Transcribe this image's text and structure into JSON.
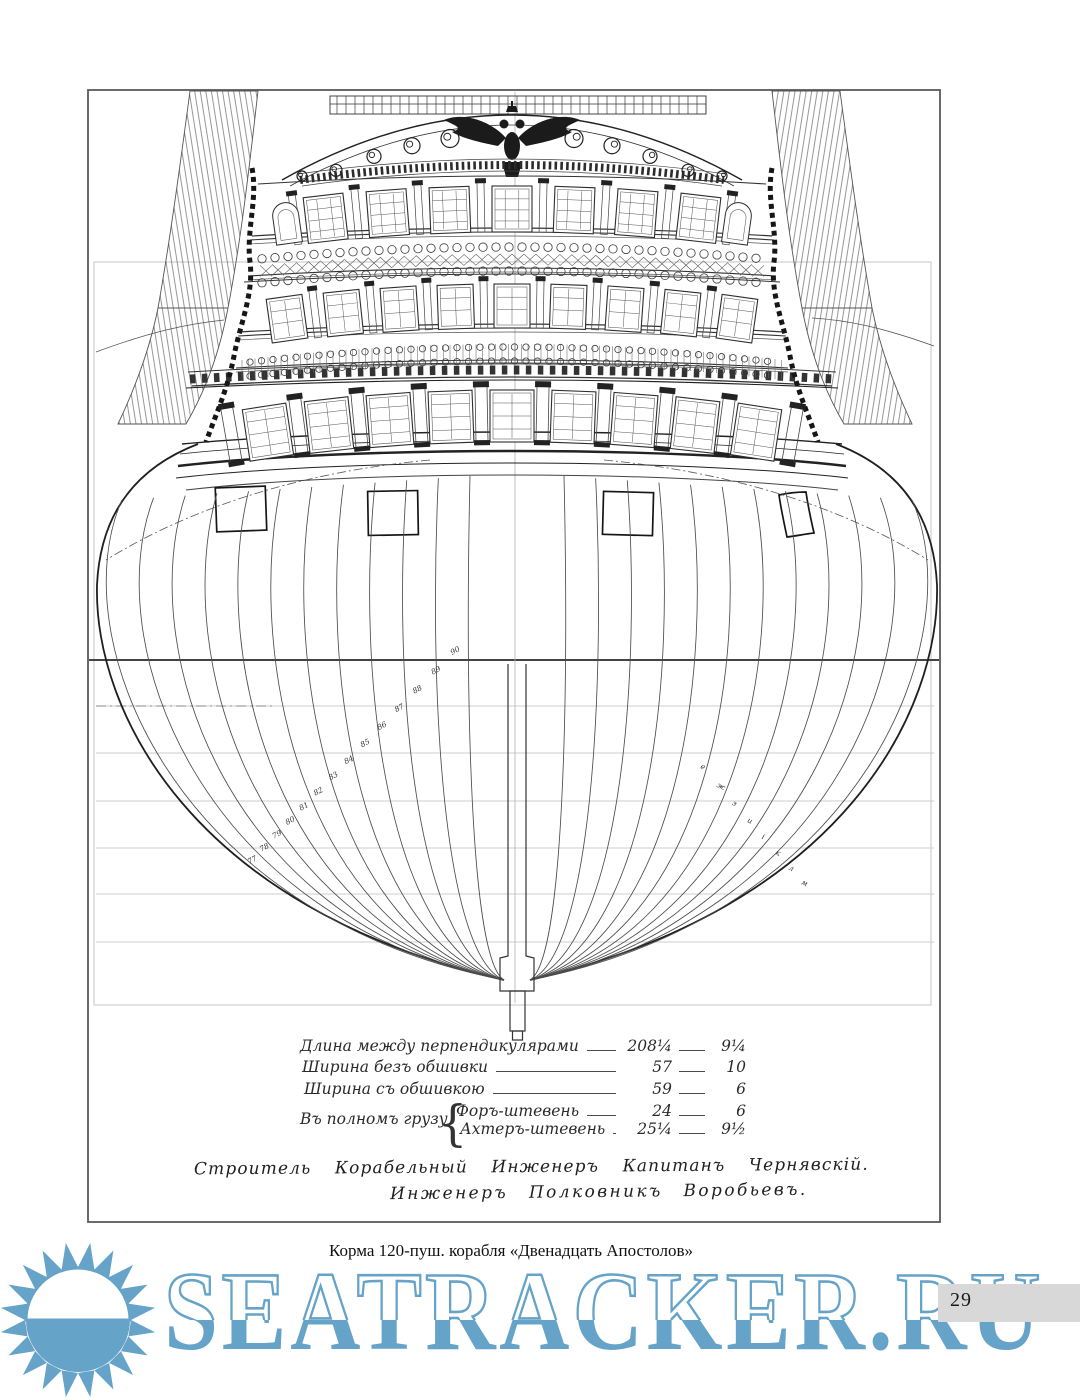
{
  "page_number": "29",
  "caption": "Корма 120-пуш. корабля «Двенадцать Апостолов»",
  "watermark": {
    "text": "SEATRACKER.RU",
    "color": "#66a3c8",
    "icon": "sun-icon"
  },
  "dimension_table": {
    "group_label": "Въ полномъ грузу",
    "rows": [
      {
        "label": "Длина между перпендикулярами",
        "feet": "208¼",
        "inches": "9¼"
      },
      {
        "label": "Ширина безъ обшивки",
        "feet": "57",
        "inches": "10"
      },
      {
        "label": "Ширина съ обшивкою",
        "feet": "59",
        "inches": "6"
      },
      {
        "label": "Форъ-штевень",
        "feet": "24",
        "inches": "6"
      },
      {
        "label": "Ахтеръ-штевень",
        "feet": "25¼",
        "inches": "9½"
      }
    ]
  },
  "signatures": {
    "line1": "Строитель Корабельный Инженеръ Капитанъ Чернявскій.",
    "line2": "Инженеръ Полковникъ Воробьевъ."
  },
  "drawing": {
    "type": "stern-view-and-body-plan",
    "left_frame_labels": [
      "90",
      "89",
      "88",
      "87",
      "86",
      "85",
      "84",
      "83",
      "82",
      "81",
      "80",
      "79",
      "78",
      "77"
    ],
    "right_frame_labels": [
      "е",
      "ж",
      "з",
      "и",
      "і",
      "к",
      "л",
      "м"
    ]
  }
}
